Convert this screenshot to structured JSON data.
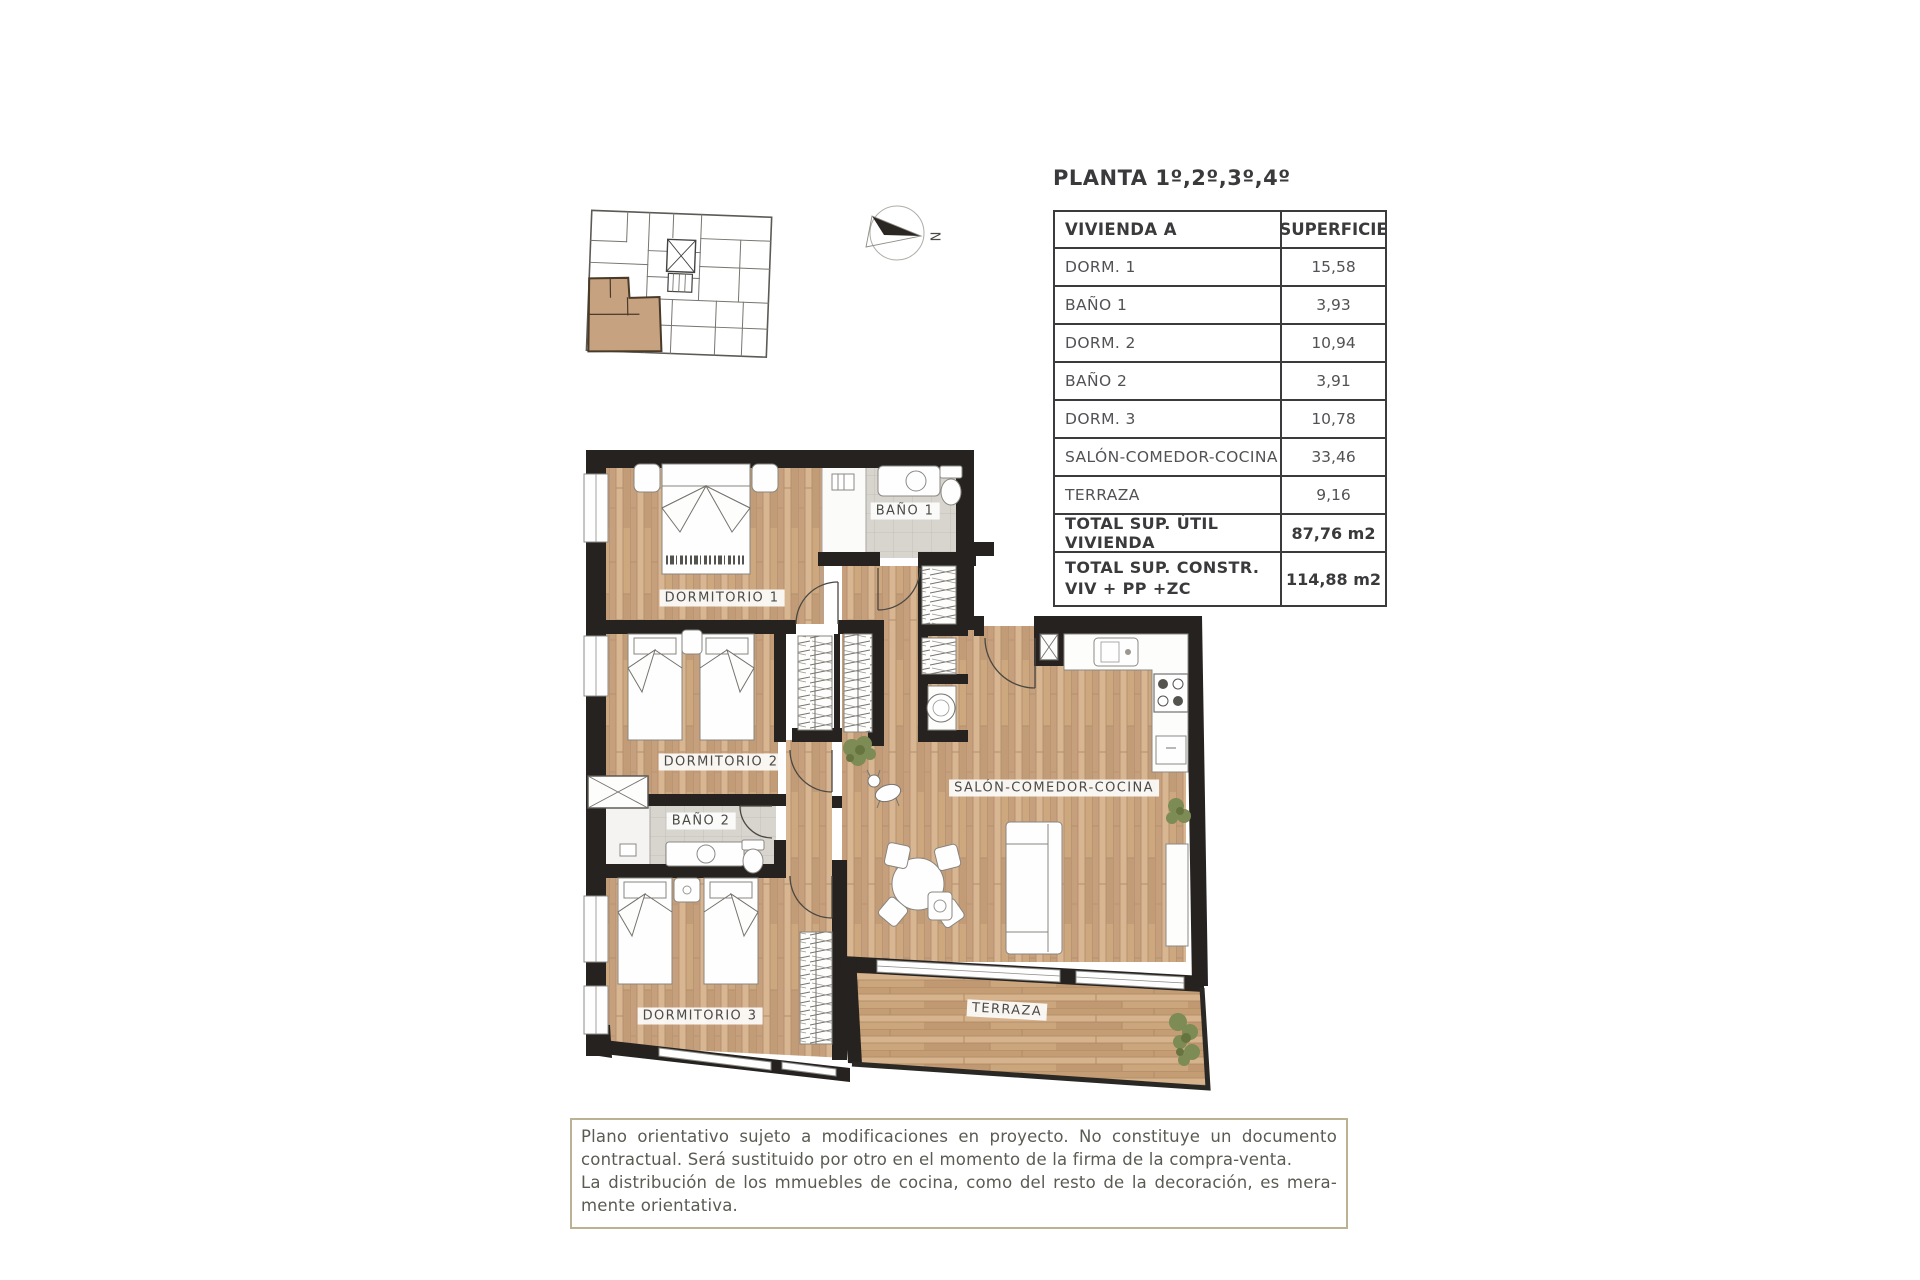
{
  "title": "PLANTA 1º,2º,3º,4º",
  "compass": {
    "north_label": "N"
  },
  "table": {
    "header": {
      "unit": "VIVIENDA A",
      "area": "SUPERFICIE"
    },
    "rows": [
      {
        "label": "DORM. 1",
        "value": "15,58"
      },
      {
        "label": "BAÑO 1",
        "value": "3,93"
      },
      {
        "label": "DORM. 2",
        "value": "10,94"
      },
      {
        "label": "BAÑO 2",
        "value": "3,91"
      },
      {
        "label": "DORM. 3",
        "value": "10,78"
      },
      {
        "label": "SALÓN-COMEDOR-COCINA",
        "value": "33,46"
      },
      {
        "label": "TERRAZA",
        "value": "9,16"
      }
    ],
    "totals": [
      {
        "label": "TOTAL SUP. ÚTIL VIVIENDA",
        "value": "87,76 m2"
      },
      {
        "label_line1": "TOTAL SUP. CONSTR.",
        "label_line2": "VIV + PP +ZC",
        "value": "114,88 m2"
      }
    ]
  },
  "plan_labels": {
    "dormitorio1": "DORMITORIO 1",
    "banio1": "BAÑO 1",
    "dormitorio2": "DORMITORIO 2",
    "banio2": "BAÑO 2",
    "dormitorio3": "DORMITORIO 3",
    "salon": "SALÓN-COMEDOR-COCINA",
    "terraza": "TERRAZA"
  },
  "disclaimer": {
    "lines": [
      "Plano orientativo sujeto a modificaciones en proyecto. No constituye un documento",
      "contractual. Será sustituido por otro en el momento de la firma de la compra-venta.",
      "La distribución de los mmuebles de cocina, como del resto de la decoración, es mera-",
      "mente orientativa."
    ]
  },
  "colors": {
    "wood": "#cfa985",
    "wall": "#252220",
    "tile": "#d7d4ce",
    "highlight_unit": "#c6a280",
    "disclaimer_border": "#bab293"
  }
}
